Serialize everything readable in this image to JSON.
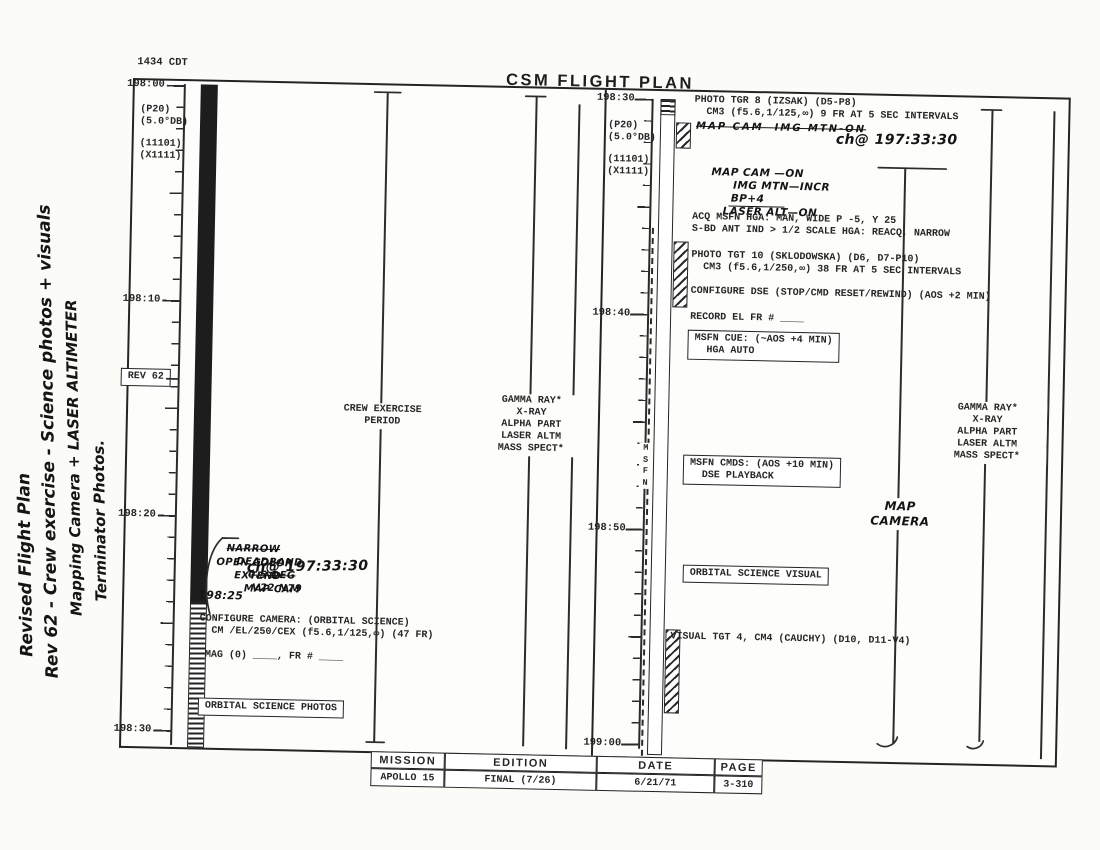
{
  "page": {
    "scan_time_note": "1434 CDT",
    "title": "CSM FLIGHT PLAN"
  },
  "margin_note": {
    "line1": "Revised Flight Plan",
    "line2": "Rev 62 - Crew exercise - Science photos + visuals",
    "line3": "Mapping Camera + LASER ALTIMETER",
    "line4": "Terminator Photos."
  },
  "left_panel": {
    "time_labels": [
      "198:00",
      "198:10",
      "198:20",
      "198:30"
    ],
    "attitude_note_a": "(P20)\n(5.0°DB)",
    "attitude_note_b": "(11101)\n(X1111)",
    "rev_box": "REV 62",
    "crew_exercise": "CREW EXERCISE\nPERIOD",
    "experiments": "GAMMA RAY*\nX-RAY\nALPHA PART\nLASER ALTM\nMASS SPECT*",
    "hand_r1_a": "NARROW",
    "hand_r1_b": "DEADBAND",
    "hand_r1_c": "0.5 DEG",
    "hand_r1_d": "V22 N79",
    "hand_r2_a": "OPEN COLOR",
    "hand_r2_b": "EXTEND",
    "hand_r2_c": "MAP CAM",
    "hand_ch_time": "ch@ 197:33:30",
    "hand_time_mark": "198:25",
    "configure_camera": "CONFIGURE CAMERA: (ORBITAL SCIENCE)\n  CM /EL/250/CEX (f5.6,1/125,∞) (47 FR)",
    "mag_line": "MAG (0) ____, FR # ____",
    "photos_box": "ORBITAL SCIENCE PHOTOS"
  },
  "right_panel": {
    "time_labels": [
      "198:30",
      "198:40",
      "198:50",
      "199:00"
    ],
    "attitude_note_a": "(P20)\n(5.0°DB)",
    "attitude_note_b": "(11101)\n(X1111)",
    "photo_tgr8": "PHOTO TGR 8 (IZSAK) (D5-P8)\n  CM3 (f5.6,1/125,∞) 9 FR AT 5 SEC INTERVALS",
    "hand_strike": "MAP CAM  IMG MTN-ON",
    "hand_ch_time": "ch@ 197:33:30",
    "hand2_a": "MAP CAM —ON",
    "hand2_b": "IMG MTN—INCR",
    "hand2_c": "BP+4",
    "hand2_d": "LASER ALT—ON",
    "acq_msfn": "ACQ MSFN HGA: MAN, WIDE P -5, Y 25\nS-BD ANT IND > 1/2 SCALE HGA: REACQ, NARROW",
    "photo_tgt10": "PHOTO TGT 10 (SKLODOWSKA) (D6, D7-P10)\n  CM3 (f5.6,1/250,∞) 38 FR AT 5 SEC INTERVALS",
    "configure_dse": "CONFIGURE DSE (STOP/CMD RESET/REWIND) (AOS +2 MIN)",
    "record_el": "RECORD EL FR # ____",
    "msfn_cue_box": "MSFN CUE: (~AOS +4 MIN)\n  HGA AUTO",
    "msfn_cmds_box": "MSFN CMDS: (AOS +10 MIN)\n  DSE PLAYBACK",
    "orbital_visual_box": "ORBITAL SCIENCE VISUAL",
    "visual_tgt4": "VISUAL TGT 4, CM4 (CAUCHY) (D10, D11-V4)",
    "msfn_vertical": "M\nS\nF\nN",
    "map_camera_hand": "MAP\nCAMERA",
    "experiments": "GAMMA RAY*\nX-RAY\nALPHA PART\nLASER ALTM\nMASS SPECT*"
  },
  "footer": {
    "mission_label": "MISSION",
    "mission_value": "APOLLO 15",
    "edition_label": "EDITION",
    "edition_value": "FINAL (7/26)",
    "date_label": "DATE",
    "date_value": "6/21/71",
    "page_label": "PAGE",
    "page_value": "3-310"
  },
  "colors": {
    "ink": "#262626",
    "paper": "#fdfdfb"
  }
}
